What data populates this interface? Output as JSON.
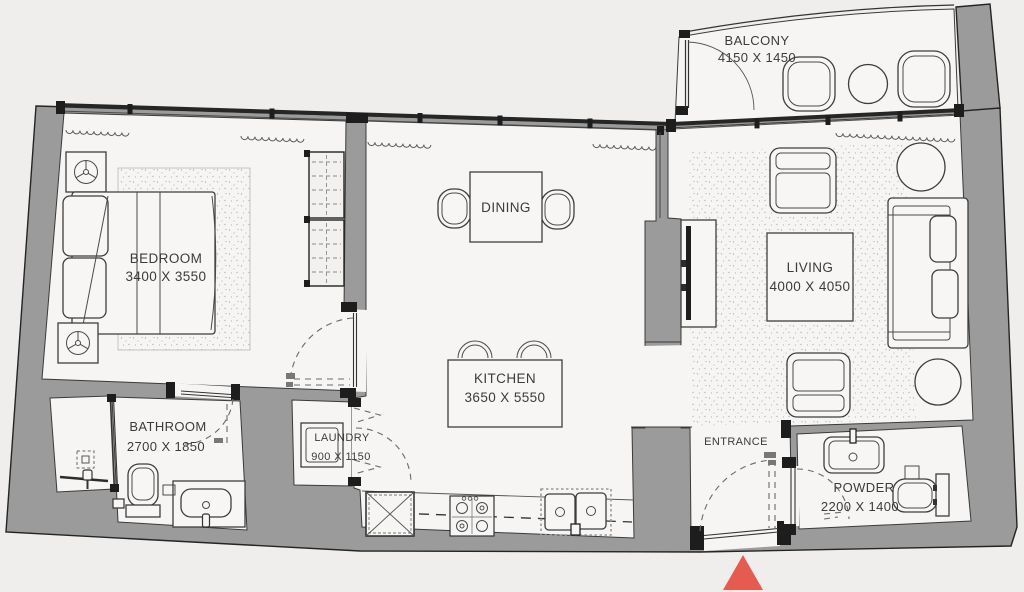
{
  "plan": {
    "rooms": {
      "balcony": {
        "name": "BALCONY",
        "dims": "4150 X 1450"
      },
      "bedroom": {
        "name": "BEDROOM",
        "dims": "3400 X 3550"
      },
      "dining": {
        "name": "DINING"
      },
      "kitchen": {
        "name": "KITCHEN",
        "dims": "3650 X 5550"
      },
      "living": {
        "name": "LIVING",
        "dims": "4000 X 4050"
      },
      "bathroom": {
        "name": "BATHROOM",
        "dims": "2700 X 1850"
      },
      "laundry": {
        "name": "LAUNDRY",
        "dims": "900 X 1150"
      },
      "entrance": {
        "name": "ENTRANCE"
      },
      "powder": {
        "name": "POWDER",
        "dims": "2200 X 1400"
      }
    },
    "colors": {
      "wall": "#9b9b9b",
      "outline": "#242424",
      "floor": "#f6f5f3",
      "background": "#efeeec",
      "entrance_marker": "#e65b50"
    }
  }
}
